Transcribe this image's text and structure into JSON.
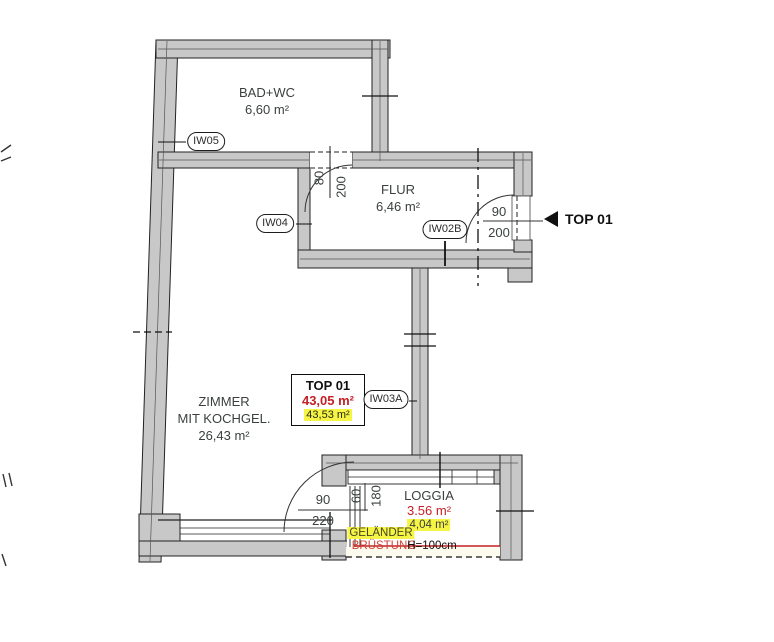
{
  "drawing": {
    "type": "floor-plan",
    "colors": {
      "wall_fill": "#c8c8c8",
      "line": "#222222",
      "accent_red": "#c32026",
      "accent_red_soft": "#cc4537",
      "highlight_yellow": "#f6f545",
      "text": "#3a403d"
    }
  },
  "unit": {
    "entry_label": "TOP 01",
    "summary": {
      "title": "TOP 01",
      "area_weighted": "43,05 m²",
      "area_total": "43,53 m²"
    }
  },
  "rooms": {
    "bad_wc": {
      "name": "BAD+WC",
      "area": "6,60 m²"
    },
    "flur": {
      "name": "FLUR",
      "area": "6,46 m²"
    },
    "zimmer": {
      "name_line1": "ZIMMER",
      "name_line2": "MIT KOCHGEL.",
      "area": "26,43 m²"
    },
    "loggia": {
      "name": "LOGGIA",
      "area_red": "3.56 m²",
      "area_alt": "4,04 m²"
    }
  },
  "tags": {
    "iw05": "IW05",
    "iw04": "IW04",
    "iw02b": "IW02B",
    "iw03a": "IW03A"
  },
  "dimensions": {
    "bad_door": {
      "width": "80",
      "height": "200"
    },
    "entry_door": {
      "width": "90",
      "height": "200"
    },
    "loggia_door": {
      "width": "90",
      "height": "220"
    },
    "loggia_window": {
      "width": "60",
      "height": "180"
    }
  },
  "railing": {
    "label1": "GELÄNDER",
    "label2": "BRÜSTUNG",
    "height": "H=100cm"
  }
}
